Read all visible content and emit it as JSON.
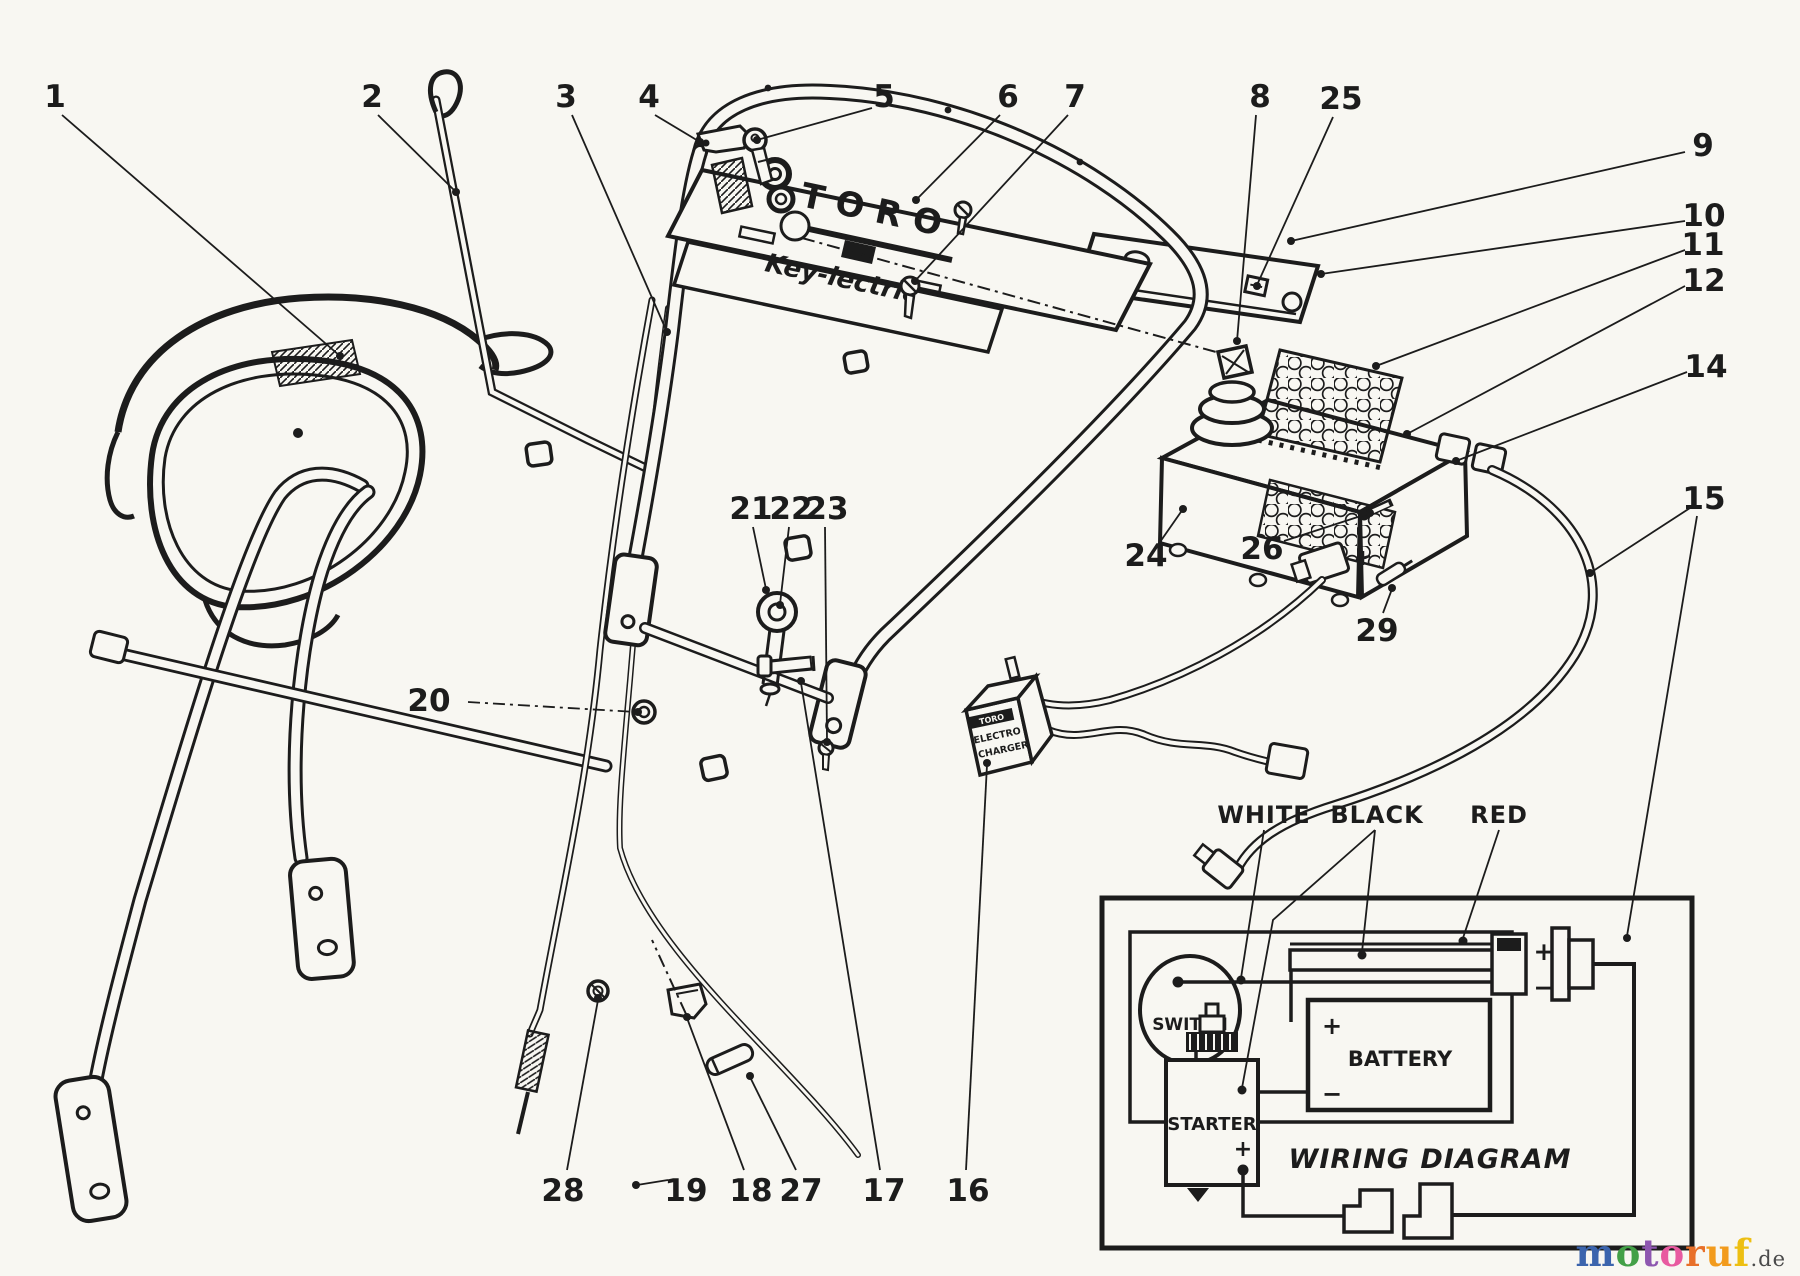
{
  "colors": {
    "paper": "#f8f7f2",
    "ink": "#1c1c1c"
  },
  "parts_diagram": {
    "panel": {
      "brand": "TORO",
      "model": "Key-lectric"
    },
    "charger": {
      "line1": "TORO",
      "line2": "ELECTRO",
      "line3": "CHARGER"
    },
    "wiring": {
      "title": "WIRING DIAGRAM",
      "switch": "SWITCH",
      "battery": "BATTERY",
      "starter": "STARTER",
      "white": "WHITE",
      "black": "BLACK",
      "red": "RED",
      "plus": "+",
      "minus": "−"
    },
    "callouts": {
      "c1": "1",
      "c2": "2",
      "c3": "3",
      "c4": "4",
      "c5": "5",
      "c6": "6",
      "c7": "7",
      "c8": "8",
      "c9": "9",
      "c10": "10",
      "c11": "11",
      "c12": "12",
      "c14": "14",
      "c15": "15",
      "c16": "16",
      "c17": "17",
      "c18": "18",
      "c19": "19",
      "c20": "20",
      "c21": "21",
      "c22": "22",
      "c23": "23",
      "c24": "24",
      "c25": "25",
      "c26": "26",
      "c27": "27",
      "c28": "28",
      "c29": "29"
    }
  },
  "footer": {
    "letters": [
      {
        "ch": "m",
        "color": "#3b64ad"
      },
      {
        "ch": "o",
        "color": "#43a047"
      },
      {
        "ch": "t",
        "color": "#8e57b0"
      },
      {
        "ch": "o",
        "color": "#e85aa0"
      },
      {
        "ch": "r",
        "color": "#e8702a"
      },
      {
        "ch": "u",
        "color": "#f29b1d"
      },
      {
        "ch": "f",
        "color": "#edbf12"
      }
    ],
    "suffix": ".de",
    "suffix_color": "#4a4a4a"
  }
}
